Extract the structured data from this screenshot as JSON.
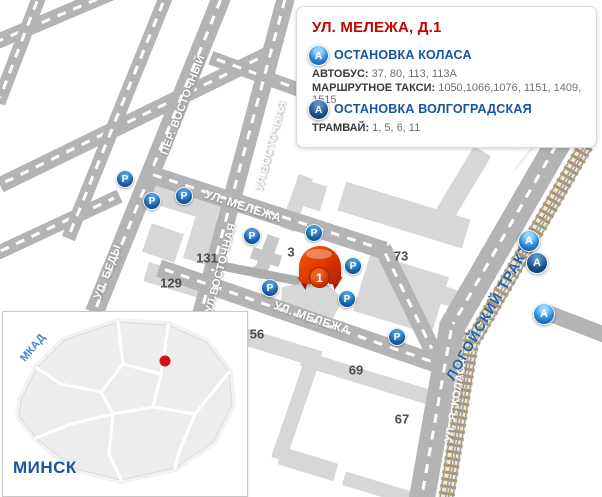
{
  "info_box": {
    "title": "УЛ. МЕЛЕЖА, Д.1",
    "stops": [
      {
        "name": "ОСТАНОВКА КОЛАСА",
        "lines": [
          {
            "label": "АВТОБУС:",
            "values": "37, 80, 113, 113А"
          },
          {
            "label": "МАРШРУТНОЕ ТАКСИ:",
            "values": "1050,1066,1076, 1151, 1409, 1515"
          }
        ]
      },
      {
        "name": "ОСТАНОВКА ВОЛГОГРАДСКАЯ",
        "lines": [
          {
            "label": "ТРАМВАЙ:",
            "values": "1, 5, 6, 11"
          }
        ]
      }
    ]
  },
  "map": {
    "marker": {
      "number": "1"
    },
    "parking_letter": "Р",
    "stop_letter": "А",
    "street_labels": {
      "per_vostochny": "ПЕР. ВОСТОЧНЫЙ",
      "ul_bedy": "УЛ. БЕДЫ",
      "ul_vostochnaya": "УЛ.ВОСТОЧНАЯ",
      "ul_melezha": "УЛ. МЕЛЕЖА",
      "logoisky_trakt": "ЛОГОЙСКИЙ ТРАКТ",
      "ul_ya_kolasa": "УЛ. Я. КОЛАСА"
    },
    "building_numbers": {
      "n131": "131",
      "n129": "129",
      "n3": "3",
      "n73": "73",
      "n56": "56",
      "n69": "69",
      "n67": "67"
    }
  },
  "inset": {
    "city_label": "МИНСК",
    "ring_road_label": "МКАД"
  },
  "colors": {
    "accent_red": "#cc0000",
    "heading_blue": "#14569b",
    "street_gray": "#b4b4b4",
    "building_gray": "#d7d7d7",
    "railway_tie": "#b3925e"
  }
}
